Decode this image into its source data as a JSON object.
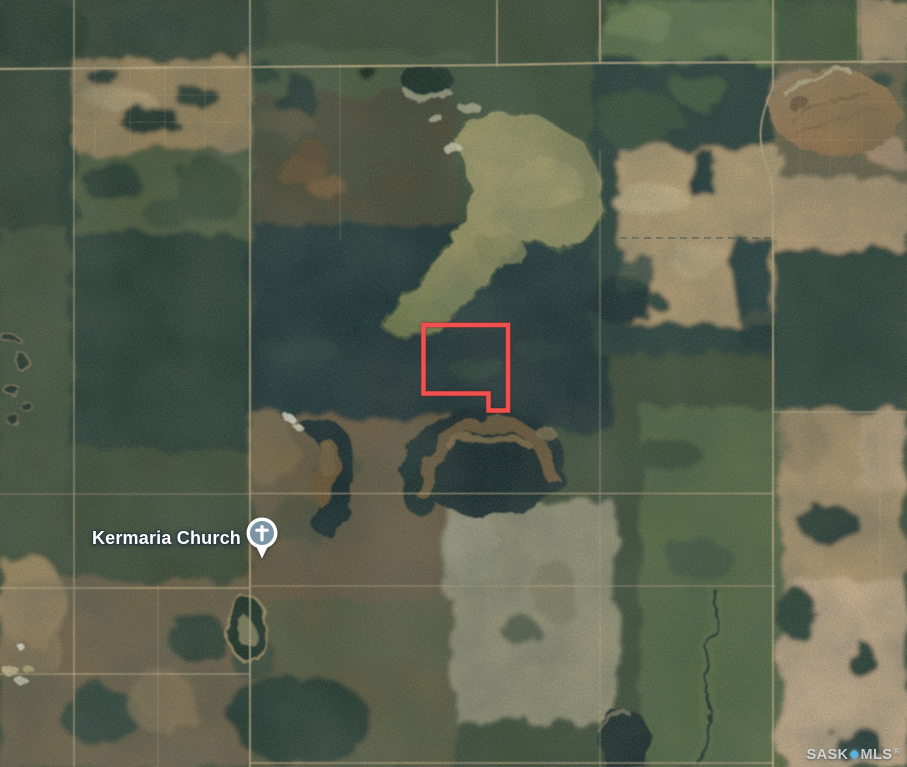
{
  "map": {
    "view": "satellite",
    "labels": {
      "church": {
        "name": "Kermaria Church",
        "icon": "church-cross-pin",
        "pin_color": "#7c95a4"
      }
    },
    "parcel_outline": {
      "color": "#f2504e",
      "points": "423.5,325 508,325 508,410.5 488.5,410.5 488.5,393.5 423.5,393.5"
    },
    "watermark": {
      "prefix": "SASK",
      "separator_glyph": "◆",
      "suffix": "MLS",
      "registered": "®",
      "text_color": "#e4eaee",
      "diamond_color": "#49b7ea"
    },
    "palette": {
      "accent_parcel_red": "#f2504e",
      "road_tan": "#cdb58c",
      "slough_olive": "#9a9565",
      "forest_dark": "#1f3234",
      "field_tan": "#bca076"
    }
  }
}
